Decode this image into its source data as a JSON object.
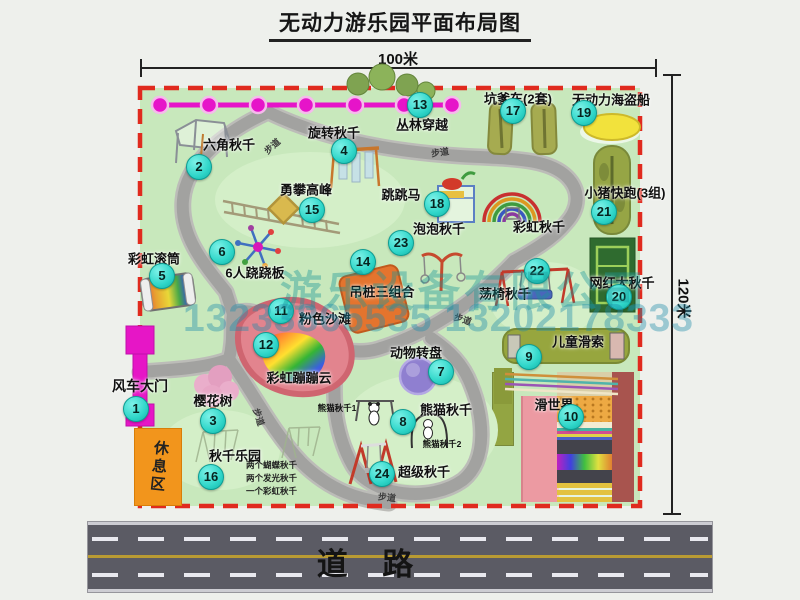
{
  "title": "无动力游乐园平面布局图",
  "dims": {
    "width": "100米",
    "height": "120米"
  },
  "road": {
    "label": "道    路"
  },
  "watermark": {
    "company": "游乐设备有限公司",
    "phone": "13233865535 13202178333"
  },
  "rest_area_label": "休息区",
  "path_label": "步道",
  "colors": {
    "map_green": "#c8e8bc",
    "border_red": "#e02a1e",
    "badge_cyan": "#2fd6c9",
    "gate_magenta": "#e616c6",
    "rest_orange": "#f2951c"
  },
  "attractions": [
    {
      "num": "1",
      "name": "风车大门"
    },
    {
      "num": "2",
      "name": "六角秋千"
    },
    {
      "num": "3",
      "name": "樱花树"
    },
    {
      "num": "4",
      "name": "旋转秋千"
    },
    {
      "num": "5",
      "name": "彩虹滚筒"
    },
    {
      "num": "6",
      "name": "6人跷跷板"
    },
    {
      "num": "7",
      "name": "动物转盘"
    },
    {
      "num": "8",
      "name": "熊猫秋千"
    },
    {
      "num": "9",
      "name": "儿童滑索"
    },
    {
      "num": "10",
      "name": "滑世界"
    },
    {
      "num": "11",
      "name": "粉色沙滩"
    },
    {
      "num": "12",
      "name": "彩虹蹦蹦云"
    },
    {
      "num": "13",
      "name": "丛林穿越"
    },
    {
      "num": "14",
      "name": "吊桩三组合"
    },
    {
      "num": "15",
      "name": "勇攀高峰"
    },
    {
      "num": "16",
      "name": "秋千乐园"
    },
    {
      "num": "17",
      "name": "坑爹车(2套)"
    },
    {
      "num": "18",
      "name": "跳跳马"
    },
    {
      "num": "19",
      "name": "无动力海盗船"
    },
    {
      "num": "20",
      "name": "网红大秋千"
    },
    {
      "num": "21",
      "name": "小猪快跑(3组)"
    },
    {
      "num": "22",
      "name": "荡椅秋千"
    },
    {
      "num": "23",
      "name": "泡泡秋千"
    },
    {
      "num": "24",
      "name": "超级秋千"
    }
  ],
  "extra_labels": {
    "rainbow_swing": "彩虹秋千",
    "panda1": "熊猫秋千1",
    "panda2": "熊猫秋千2"
  },
  "swing_notes": [
    "两个蝴蝶秋千",
    "两个发光秋千",
    "一个彩虹秋千"
  ]
}
